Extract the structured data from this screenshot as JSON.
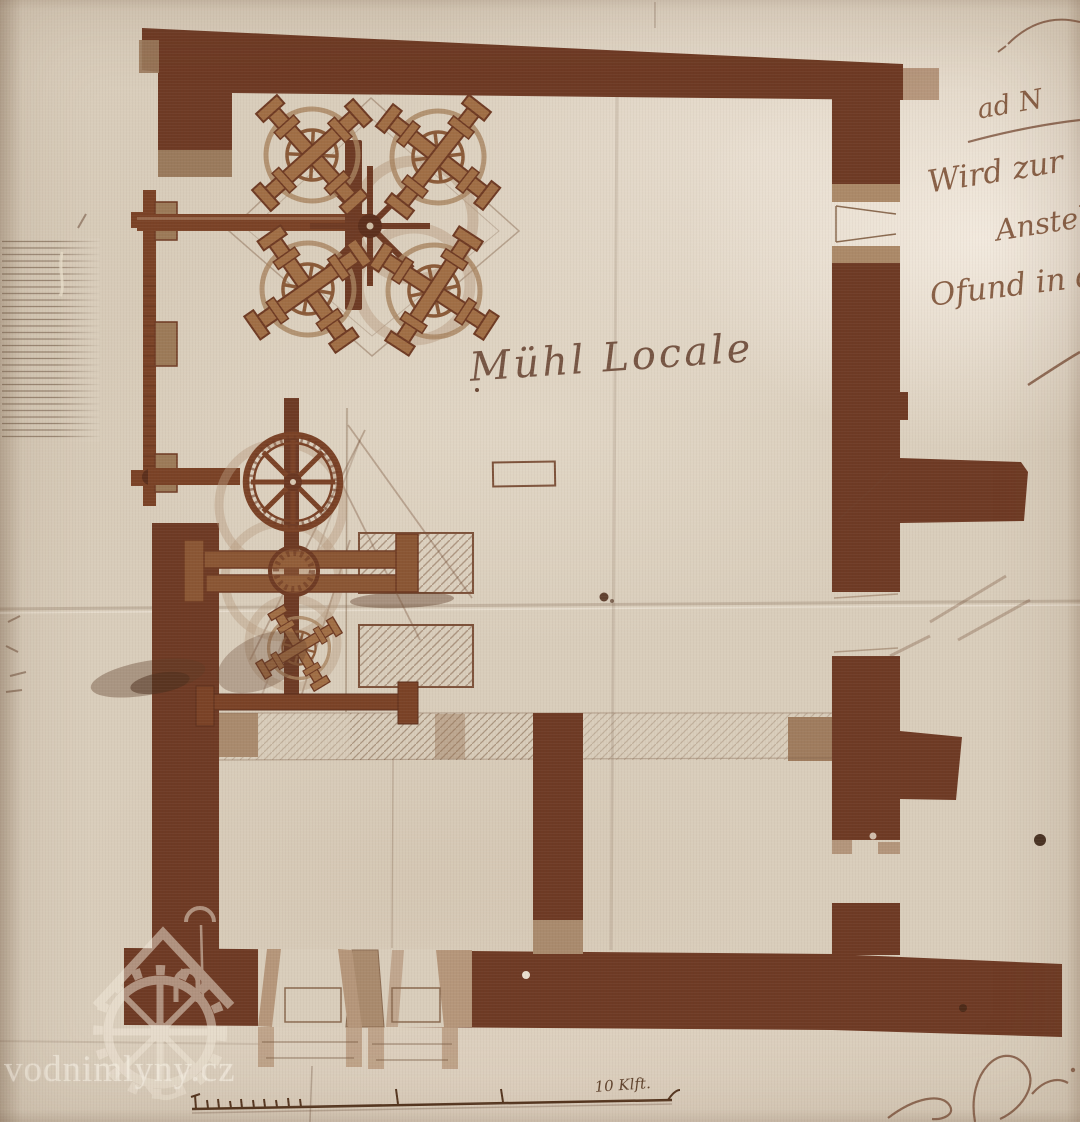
{
  "page": {
    "plan_title": "Mühl Locale",
    "scale_label": "10 Klft.",
    "watermark_text": "vodnimlyny.cz",
    "handwriting_lines": [
      "ad N",
      "Wird zur",
      "Anstellu",
      "Ofund in d"
    ],
    "icons": {
      "watermill_logo": "watermill-house-logo",
      "millstone": "millstone-cross-icon",
      "crown_gear": "eight-spoke-gear-icon"
    },
    "palette": {
      "paper": "#d9cdbb",
      "paper_bright": "#efe6d8",
      "wall_dark": "#6e3a24",
      "wall_medium": "#8a5634",
      "wall_light": "#a98a6d",
      "ink_brown": "#7b4e33",
      "pencil": "#8a6a52",
      "watermark": "#f2e9da"
    }
  }
}
